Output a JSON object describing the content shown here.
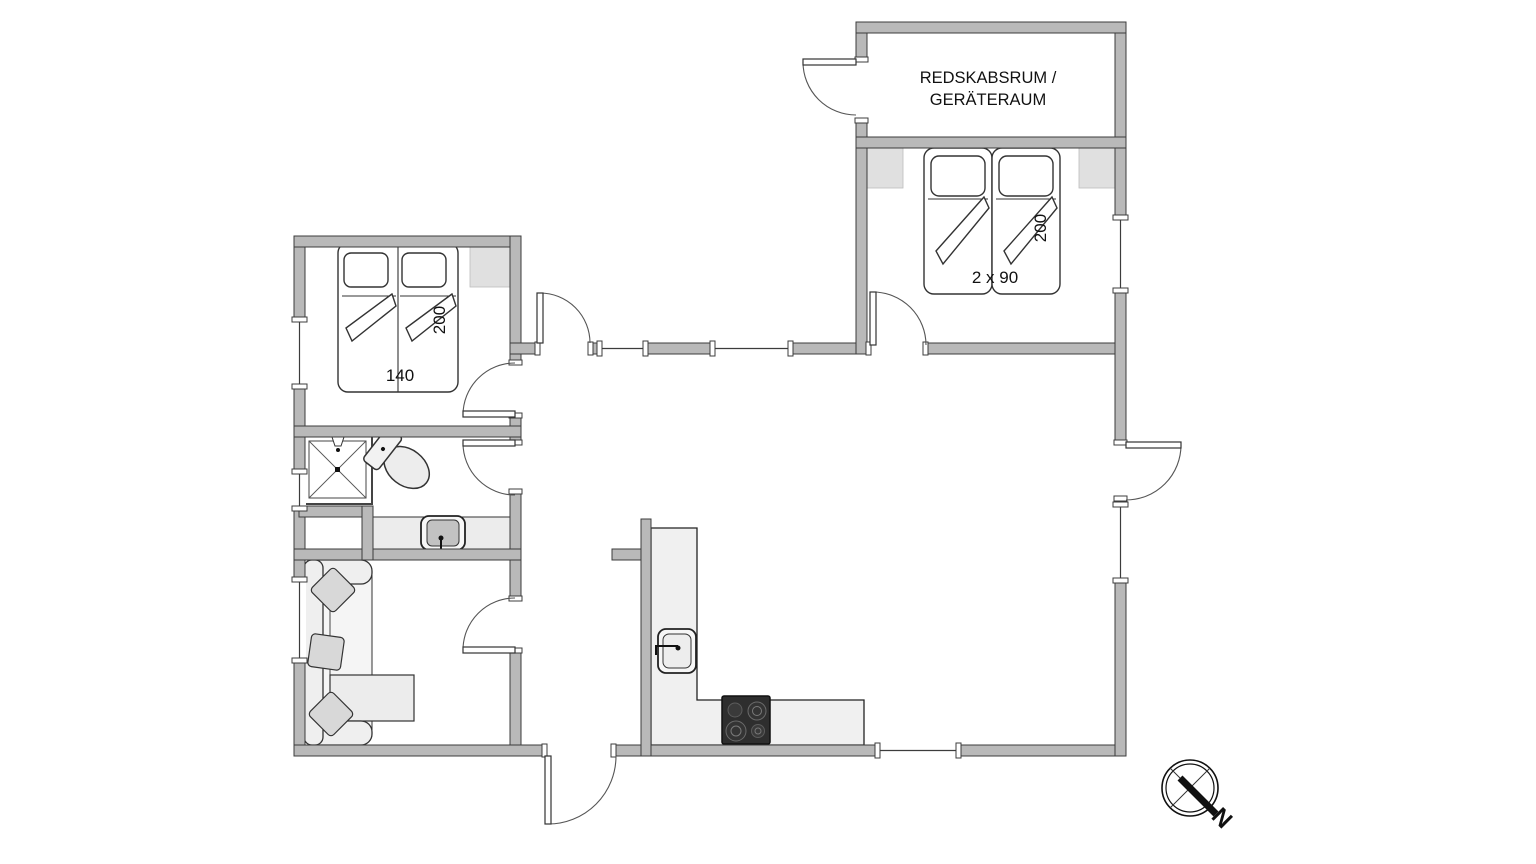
{
  "floorplan": {
    "tool_room": {
      "label_line1": "REDSKABSRUM /",
      "label_line2": "GERÄTERAUM"
    },
    "bedroom_left": {
      "bed_width": "140",
      "bed_length": "200"
    },
    "bedroom_right": {
      "bed_width": "2 x 90",
      "bed_length": "200"
    },
    "compass": {
      "north": "N"
    },
    "colors": {
      "wall": "#b9b9b9",
      "wall_outline": "#3c3c3c",
      "counter": "#f0f0f0",
      "stove": "#2e2e2e",
      "pillow": "#d8d8d8",
      "wardrobe": "#e0e0e0"
    }
  }
}
